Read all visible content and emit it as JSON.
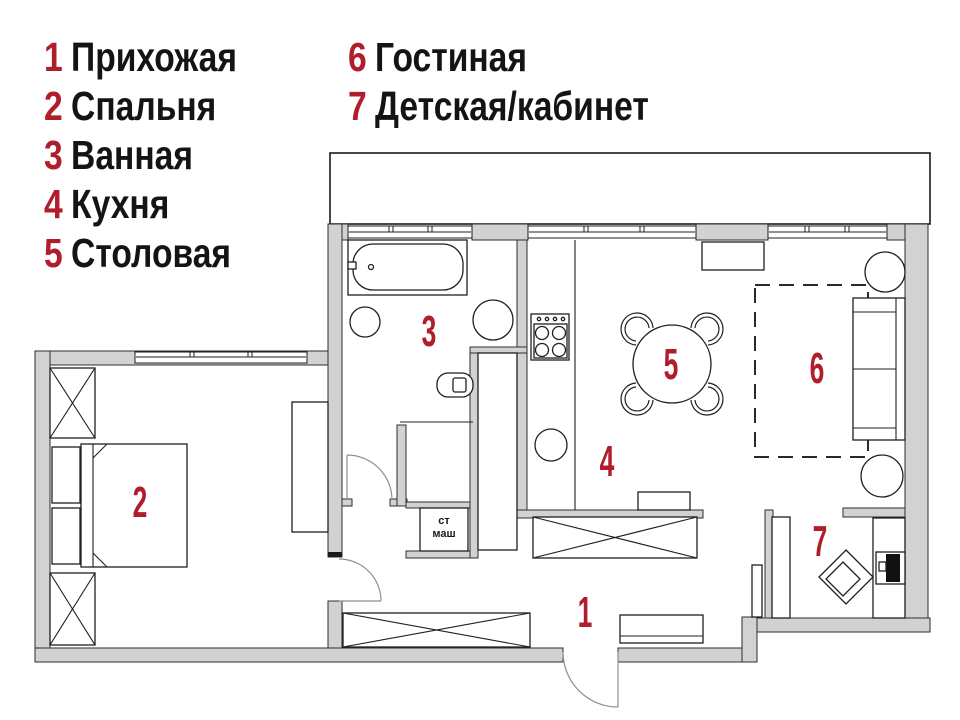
{
  "legend": {
    "columns": [
      {
        "items": [
          {
            "number": "1",
            "label": "Прихожая"
          },
          {
            "number": "2",
            "label": "Спальня"
          },
          {
            "number": "3",
            "label": "Ванная"
          },
          {
            "number": "4",
            "label": "Кухня"
          },
          {
            "number": "5",
            "label": "Столовая"
          }
        ]
      },
      {
        "items": [
          {
            "number": "6",
            "label": "Гостиная"
          },
          {
            "number": "7",
            "label": "Детская/кабинет"
          }
        ]
      }
    ]
  },
  "plan": {
    "room_numbers": {
      "hallway": "1",
      "bedroom": "2",
      "bathroom": "3",
      "kitchen": "4",
      "dining": "5",
      "living": "6",
      "kids_office": "7"
    },
    "washing_machine_label": {
      "line1": "ст",
      "line2": "маш"
    },
    "colors": {
      "accent": "#b01e2c",
      "wall": "#d2d2d2",
      "outline": "#2e2e2e"
    }
  }
}
